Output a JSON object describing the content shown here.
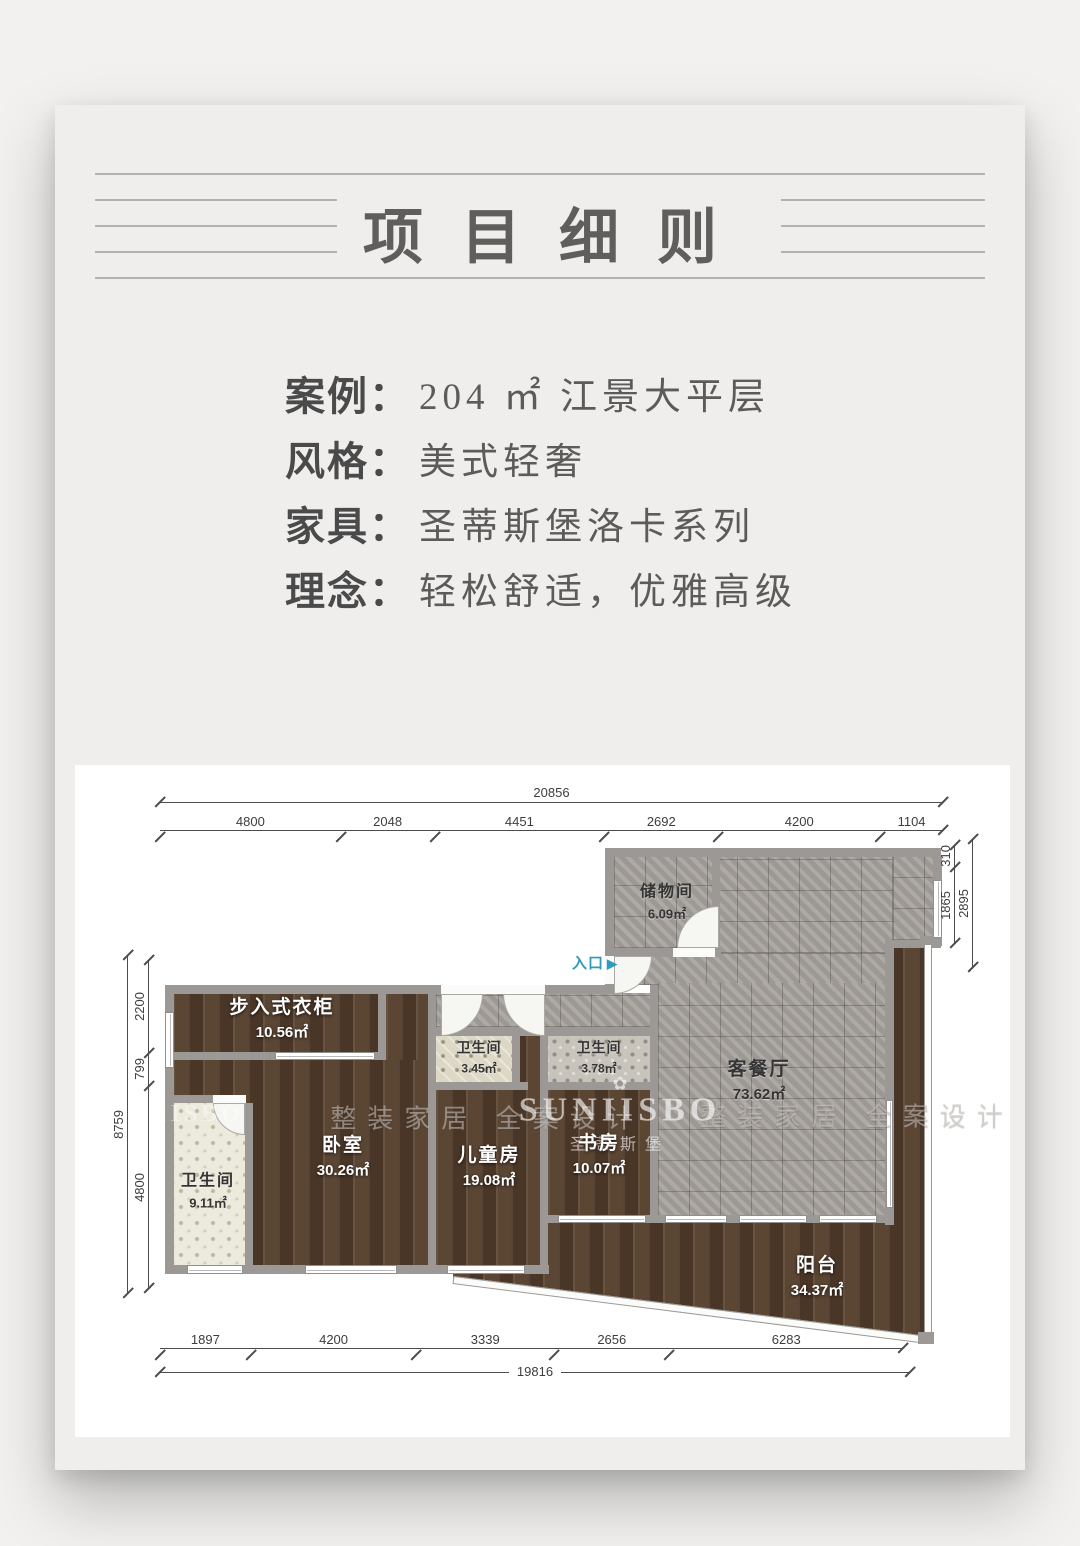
{
  "page": {
    "title": "项目细则"
  },
  "info": {
    "rows": [
      {
        "label": "案例：",
        "value": "204 ㎡ 江景大平层"
      },
      {
        "label": "风格：",
        "value": "美式轻奢"
      },
      {
        "label": "家具：",
        "value": "圣蒂斯堡洛卡系列"
      },
      {
        "label": "理念：",
        "value": "轻松舒适，优雅高级"
      }
    ]
  },
  "plan": {
    "entrance_label": "入口",
    "entrance_arrow_icon": "▶",
    "watermarks": {
      "brand": "SUNIISBO",
      "brand_cn": "圣蒂斯堡",
      "slogan": "整装家居 全案设计",
      "flower_icon": "✿"
    },
    "rooms": [
      {
        "id": "storage",
        "name": "储物间",
        "area": "6.09㎡"
      },
      {
        "id": "living",
        "name": "客餐厅",
        "area": "73.62㎡"
      },
      {
        "id": "closet",
        "name": "步入式衣柜",
        "area": "10.56㎡"
      },
      {
        "id": "bath-left",
        "name": "卫生间",
        "area": "9.11㎡"
      },
      {
        "id": "bedroom",
        "name": "卧室",
        "area": "30.26㎡"
      },
      {
        "id": "bath-mid",
        "name": "卫生间",
        "area": "3.45㎡"
      },
      {
        "id": "kids",
        "name": "儿童房",
        "area": "19.08㎡"
      },
      {
        "id": "bath-right",
        "name": "卫生间",
        "area": "3.78㎡"
      },
      {
        "id": "study",
        "name": "书房",
        "area": "10.07㎡"
      },
      {
        "id": "balcony",
        "name": "阳台",
        "area": "34.37㎡"
      }
    ],
    "dimensions": {
      "top": {
        "total": "20856",
        "segments": [
          "4800",
          "2048",
          "4451",
          "2692",
          "4200",
          "1104"
        ]
      },
      "bottom": {
        "total": "19816",
        "segments": [
          "1897",
          "4200",
          "3339",
          "2656",
          "6283"
        ]
      },
      "left": {
        "total": "8759",
        "segments": [
          "2200",
          "799",
          "4800"
        ]
      },
      "right": {
        "total": "2895",
        "segments": [
          "310",
          "1865"
        ]
      }
    },
    "colors": {
      "entrance": "#2b9cba",
      "wall": "#9b9896",
      "wood_floor": "#53402f",
      "tile_floor": "#a6a19c",
      "panel_bg": "#ffffff",
      "card_bg": "#efeeec"
    }
  }
}
